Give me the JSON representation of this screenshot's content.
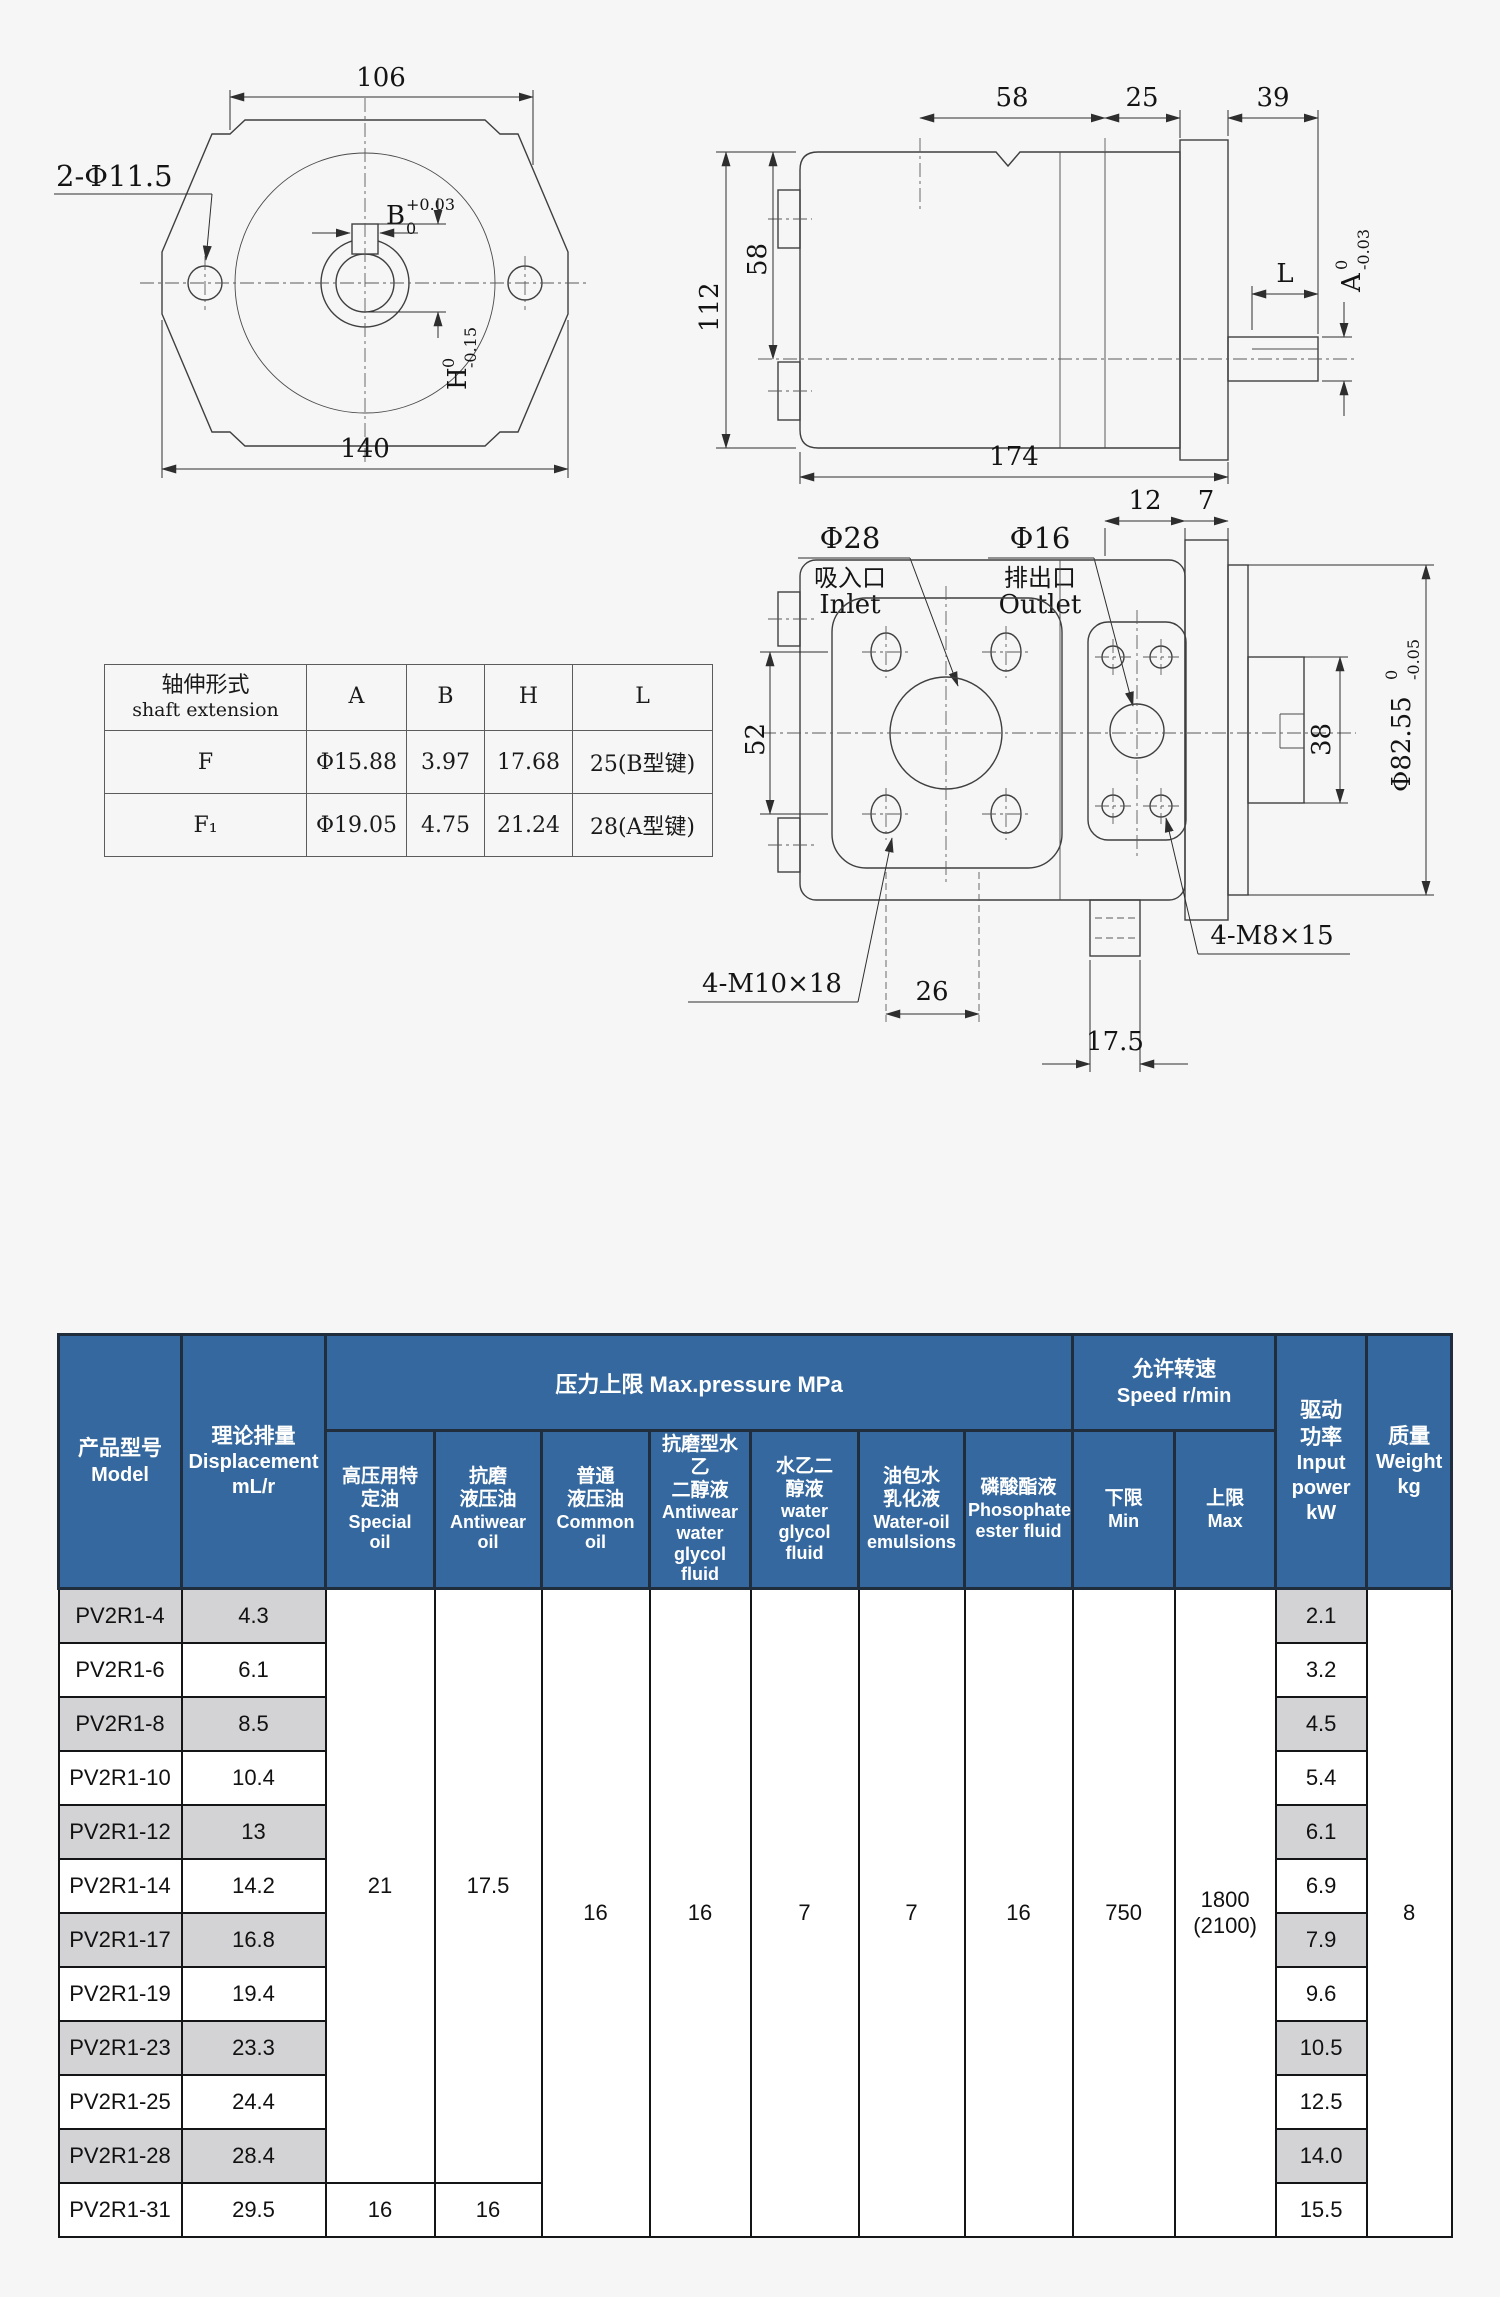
{
  "drawing": {
    "front": {
      "dim106": "106",
      "dim140": "140",
      "holes": "2-Φ11.5",
      "b": {
        "main": "B",
        "sup": "+0.03",
        "sub": "0"
      },
      "h": {
        "main": "H",
        "sup": "0",
        "sub": "-0.15"
      }
    },
    "side": {
      "d58": "58",
      "d25": "25",
      "d39": "39",
      "d58v": "58",
      "d112": "112",
      "d174": "174",
      "dL": "L",
      "a": {
        "main": "A",
        "sup": "0",
        "sub": "-0.03"
      }
    },
    "ports": {
      "d12": "12",
      "d7": "7",
      "d52": "52",
      "d38": "38",
      "d26": "26",
      "d175": "17.5",
      "m10": "4-M10×18",
      "m8": "4-M8×15",
      "phi82": {
        "main": "Φ82.55",
        "sup": "0",
        "sub": "-0.05"
      },
      "inlet": {
        "dia": "Φ28",
        "cn": "吸入口",
        "en": "Inlet"
      },
      "outlet": {
        "dia": "Φ16",
        "cn": "排出口",
        "en": "Outlet"
      }
    },
    "shaft_table": {
      "header": {
        "cn": "轴伸形式",
        "en": "shaft extension",
        "a": "A",
        "b": "B",
        "h": "H",
        "l": "L"
      },
      "rows": [
        {
          "t": "F",
          "a": "Φ15.88",
          "b": "3.97",
          "h": "17.68",
          "l": "25(B型键)"
        },
        {
          "t": "F₁",
          "a": "Φ19.05",
          "b": "4.75",
          "h": "21.24",
          "l": "28(A型键)"
        }
      ]
    }
  },
  "spec": {
    "model_cn": "产品型号",
    "model_en": "Model",
    "disp_cn": "理论排量",
    "disp_en": "Displacement\nmL/r",
    "group_pressure": "压力上限 Max.pressure MPa",
    "group_speed_cn": "允许转速",
    "group_speed_en": "Speed r/min",
    "fluids": [
      {
        "cn": "高压用特\n定油",
        "en": "Special\noil"
      },
      {
        "cn": "抗磨\n液压油",
        "en": "Antiwear\noil"
      },
      {
        "cn": "普通\n液压油",
        "en": "Common\noil"
      },
      {
        "cn": "抗磨型水乙\n二醇液",
        "en": "Antiwear\nwater\nglycol fluid"
      },
      {
        "cn": "水乙二\n醇液",
        "en": "water\nglycol\nfluid"
      },
      {
        "cn": "油包水\n乳化液",
        "en": "Water-oil\nemulsions"
      },
      {
        "cn": "磷酸酯液",
        "en": "Phosophate\nester fluid"
      }
    ],
    "min_cn": "下限",
    "min_en": "Min",
    "max_cn": "上限",
    "max_en": "Max",
    "power_cn": "驱动\n功率",
    "power_en": "Input\npower\nkW",
    "weight_cn": "质量",
    "weight_en": "Weight\nkg",
    "merged": {
      "special": "21",
      "antiwear": "17.5",
      "common": "16",
      "aw_glycol": "16",
      "glycol": "7",
      "water_oil": "7",
      "phosphate": "16",
      "min": "750",
      "max": "1800\n(2100)",
      "weight": "8",
      "last_special": "16",
      "last_antiwear": "16"
    },
    "rows": [
      {
        "model": "PV2R1-4",
        "disp": "4.3",
        "power": "2.1"
      },
      {
        "model": "PV2R1-6",
        "disp": "6.1",
        "power": "3.2"
      },
      {
        "model": "PV2R1-8",
        "disp": "8.5",
        "power": "4.5"
      },
      {
        "model": "PV2R1-10",
        "disp": "10.4",
        "power": "5.4"
      },
      {
        "model": "PV2R1-12",
        "disp": "13",
        "power": "6.1"
      },
      {
        "model": "PV2R1-14",
        "disp": "14.2",
        "power": "6.9"
      },
      {
        "model": "PV2R1-17",
        "disp": "16.8",
        "power": "7.9"
      },
      {
        "model": "PV2R1-19",
        "disp": "19.4",
        "power": "9.6"
      },
      {
        "model": "PV2R1-23",
        "disp": "23.3",
        "power": "10.5"
      },
      {
        "model": "PV2R1-25",
        "disp": "24.4",
        "power": "12.5"
      },
      {
        "model": "PV2R1-28",
        "disp": "28.4",
        "power": "14.0"
      },
      {
        "model": "PV2R1-31",
        "disp": "29.5",
        "power": "15.5"
      }
    ],
    "colors": {
      "header_bg": "#35689e",
      "row_alt": "#d3d3d6",
      "border_dark": "#1f2d3d"
    }
  }
}
